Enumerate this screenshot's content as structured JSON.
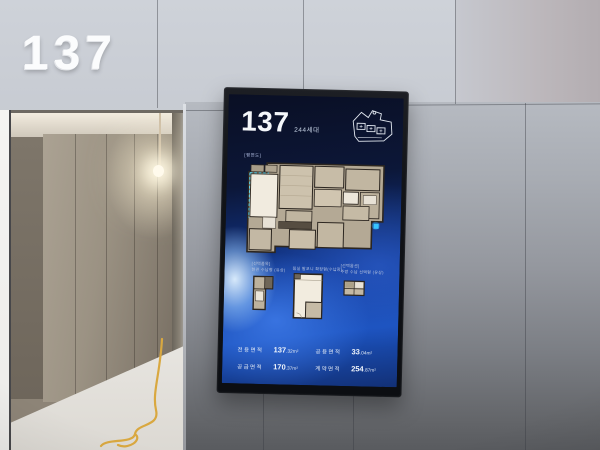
{
  "wall": {
    "unit_number": "137"
  },
  "screen": {
    "unit_number": "137",
    "unit_households": "244세대",
    "main_plan_label": "[평면도]",
    "sub_plans": [
      {
        "label": "[선택품목]",
        "sublabel": "현관 수납형 (유상)"
      },
      {
        "label": "침실 발코니 확장형(수납장)",
        "sublabel": ""
      },
      {
        "label": "[선택옵션]",
        "sublabel": "주방 수납 선택형 (유상)"
      }
    ],
    "areas": [
      {
        "label": "전용면적",
        "int": "137",
        "dec": ".32",
        "unit": "m²"
      },
      {
        "label": "공급면적",
        "int": "170",
        "dec": ".37",
        "unit": "m²"
      },
      {
        "label": "공용면적",
        "int": "33",
        "dec": ".04",
        "unit": "m²"
      },
      {
        "label": "계약면적",
        "int": "254",
        "dec": ".87",
        "unit": "m²"
      }
    ]
  }
}
